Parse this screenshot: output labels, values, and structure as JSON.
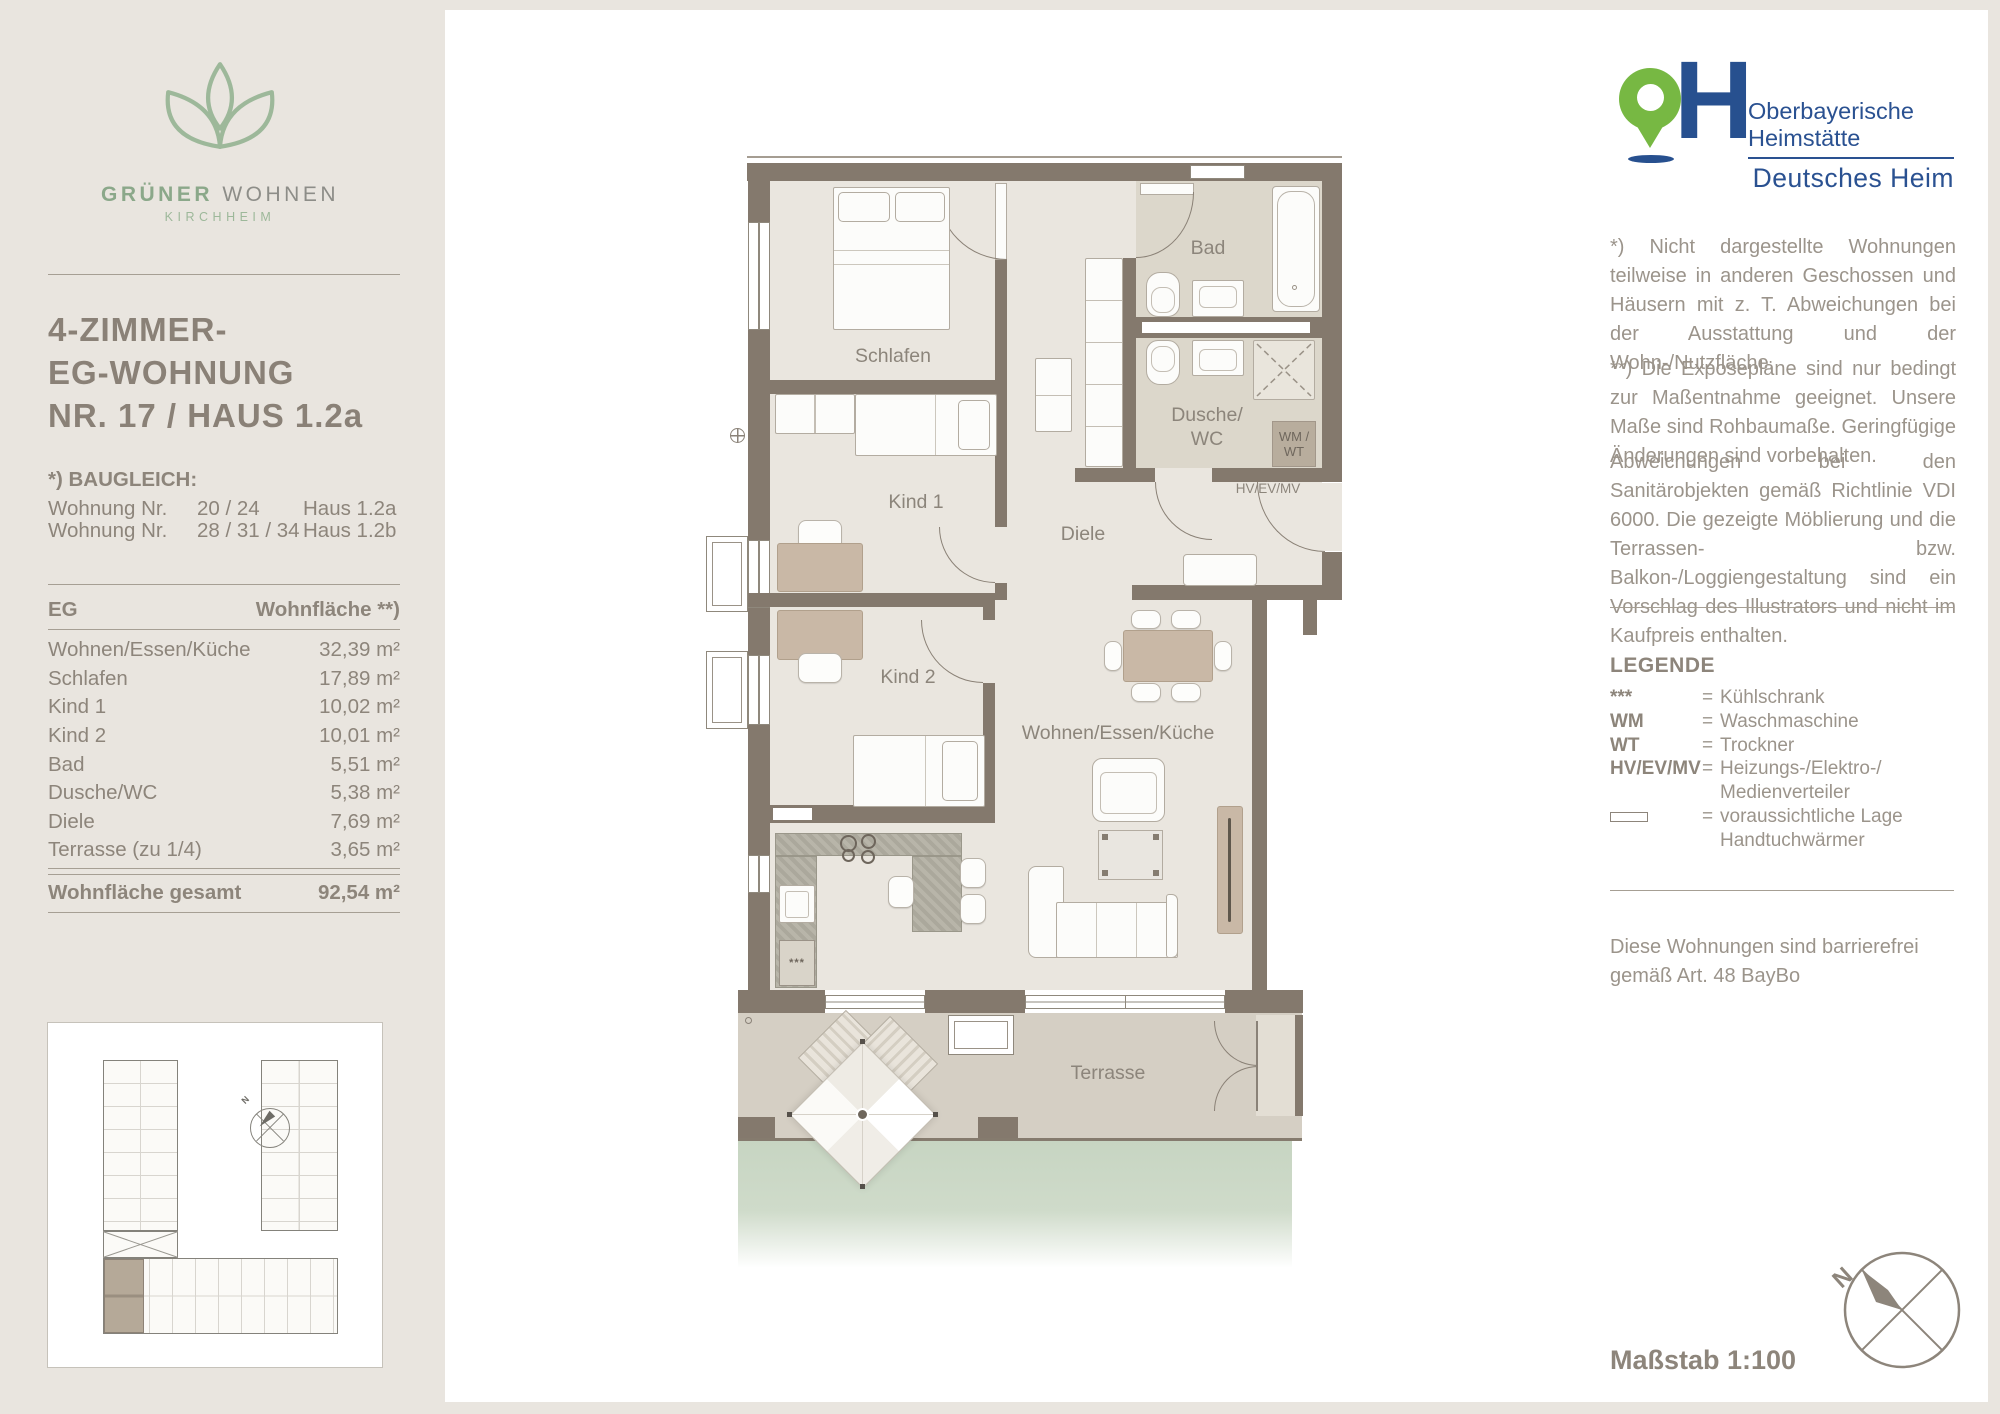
{
  "brand": {
    "name_primary": "GRÜNER",
    "name_secondary": " WOHNEN",
    "location": "KIRCHHEIM"
  },
  "listing": {
    "title_line1": "4-ZIMMER-",
    "title_line2": "EG-WOHNUNG",
    "title_line3": "NR. 17 / HAUS 1.2a"
  },
  "baugleich": {
    "heading": "*) BAUGLEICH:",
    "rows": [
      {
        "label": "Wohnung Nr.",
        "numbers": "20 / 24",
        "house": "Haus 1.2a"
      },
      {
        "label": "Wohnung Nr.",
        "numbers": "28 / 31 / 34",
        "house": "Haus 1.2b"
      }
    ]
  },
  "area_table": {
    "header_left": "EG",
    "header_right": "Wohnfläche **)",
    "rows": [
      {
        "label": "Wohnen/Essen/Küche",
        "value": "32,39 m²"
      },
      {
        "label": "Schlafen",
        "value": "17,89 m²"
      },
      {
        "label": "Kind 1",
        "value": "10,02 m²"
      },
      {
        "label": "Kind 2",
        "value": "10,01 m²"
      },
      {
        "label": "Bad",
        "value": "5,51 m²"
      },
      {
        "label": "Dusche/WC",
        "value": "5,38 m²"
      },
      {
        "label": "Diele",
        "value": "7,69 m²"
      },
      {
        "label": "Terrasse (zu 1/4)",
        "value": "3,65 m²"
      }
    ],
    "total_label": "Wohnfläche gesamt",
    "total_value": "92,54 m²"
  },
  "plan": {
    "labels": {
      "schlafen": "Schlafen",
      "bad": "Bad",
      "dusche_line1": "Dusche/",
      "dusche_line2": "WC",
      "kind1": "Kind 1",
      "kind2": "Kind 2",
      "diele": "Diele",
      "wohnen": "Wohnen/Essen/Küche",
      "terrasse": "Terrasse",
      "wm_line1": "WM /",
      "wm_line2": "WT",
      "hv": "HV/EV/MV",
      "fridge_symbol": "***"
    }
  },
  "publisher": {
    "monogram_letter": "H",
    "name_line1": "Oberbayerische",
    "name_line2": "Heimstätte",
    "brand_line": "Deutsches Heim"
  },
  "notes": {
    "note1": "*) Nicht dargestellte Wohnungen teilweise in anderen Geschossen und Häusern mit z. T. Abweichungen bei der Ausstattung und der Wohn-/Nutzfläche.",
    "note2": "**) Die Exposepläne sind nur bedingt zur Maßentnahme geeignet. Unsere Maße sind Rohbaumaße. Geringfügige Änderungen sind vorbehalten.",
    "note3": "Abweichungen bei den Sanitärobjekten gemäß Richtlinie VDI 6000. Die gezeigte Möblierung und die Terrassen- bzw. Balkon-/Loggiengestaltung sind ein Vorschlag des Illustrators und nicht im Kaufpreis enthalten."
  },
  "legend": {
    "heading": "LEGENDE",
    "equals_sign": "=",
    "items": [
      {
        "symbol": "***",
        "text1": "Kühlschrank",
        "text2": ""
      },
      {
        "symbol": "WM",
        "text1": "Waschmaschine",
        "text2": ""
      },
      {
        "symbol": "WT",
        "text1": "Trockner",
        "text2": ""
      },
      {
        "symbol": "HV/EV/MV",
        "text1": "Heizungs-/Elektro-/",
        "text2": "Medienverteiler"
      },
      {
        "symbol": "",
        "text1": "voraussichtliche Lage",
        "text2": "Handtuchwärmer"
      }
    ]
  },
  "accessibility_note": "Diese Wohnungen sind barrierefrei gemäß Art. 48 BayBo",
  "page": {
    "scale_label": "Maßstab 1:100",
    "compass_n": "N"
  },
  "colors": {
    "page_background": "#e9e5df",
    "wall": "#84796d",
    "room_floor": "#eae6df",
    "bath_floor": "#dcd7cb",
    "terrace_floor": "#d5cfc4",
    "lawn": "#c7d5c2",
    "logo_green": "#9db89a",
    "publisher_green": "#77b843",
    "publisher_blue": "#27508f",
    "text_brown": "#8d857b",
    "wood": "#c9b8a6"
  }
}
